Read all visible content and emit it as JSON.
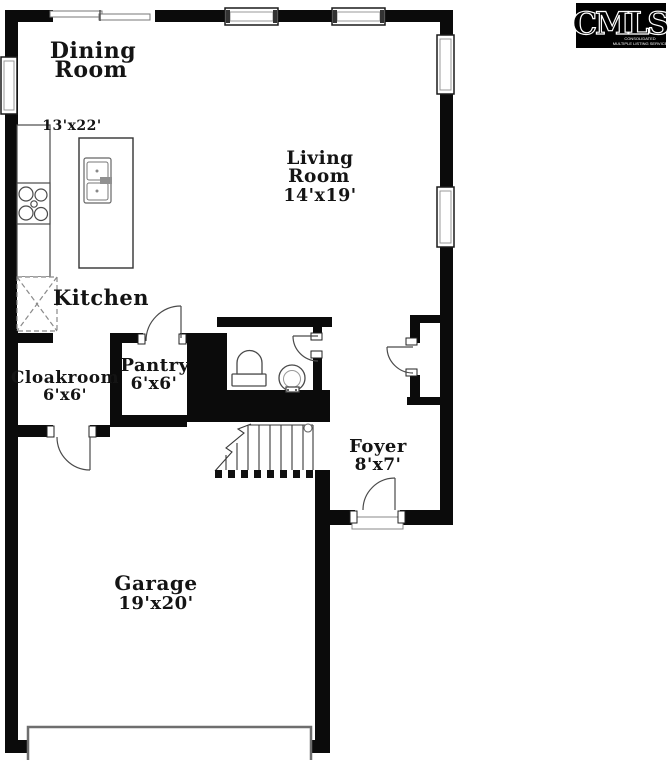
{
  "colors": {
    "wall": "#0b0b0b",
    "background": "#ffffff",
    "fixture_stroke": "#4a4a4a",
    "logo_bg": "#000000"
  },
  "rooms": {
    "dining": {
      "line1": "Dining",
      "line2": "Room",
      "dims": "13'x22'"
    },
    "living": {
      "line1": "Living",
      "line2": "Room",
      "dims": "14'x19'"
    },
    "kitchen": {
      "label": "Kitchen"
    },
    "cloakroom": {
      "label": "Cloakroom",
      "dims": "6'x6'"
    },
    "pantry": {
      "label": "Pantry",
      "dims": "6'x6'"
    },
    "foyer": {
      "label": "Foyer",
      "dims": "8'x7'"
    },
    "garage": {
      "label": "Garage",
      "dims": "19'x20'"
    }
  },
  "logo": {
    "title": "CMLS",
    "subtitle_line1": "CONSOLIDATED",
    "subtitle_line2": "MULTIPLE LISTING SERVICE"
  }
}
